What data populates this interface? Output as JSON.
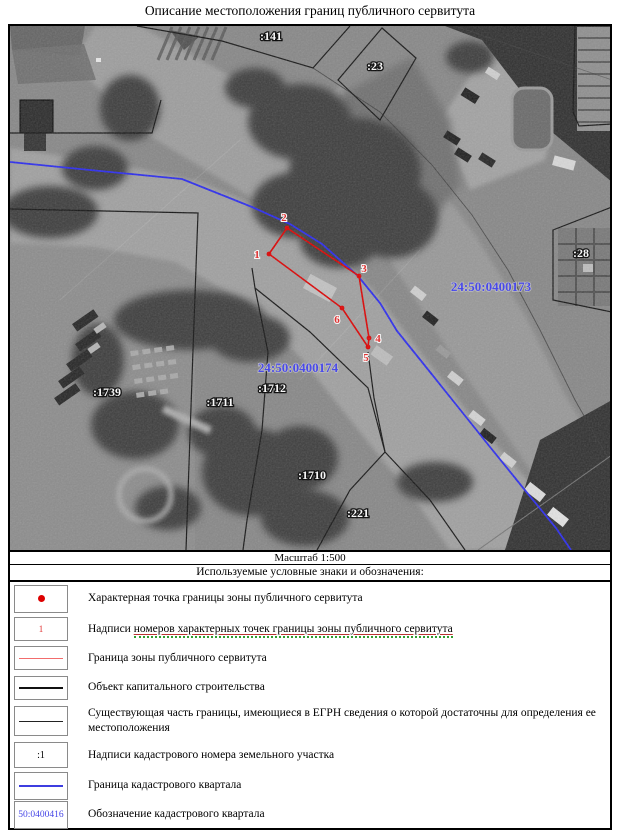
{
  "title": "Описание местоположения границ публичного сервитута",
  "scale_label": "Масштаб 1:500",
  "legend": {
    "header": "Используемые условные знаки и обозначения:",
    "rows": [
      {
        "symbol": "red-dot",
        "text": "Характерная точка границы зоны публичного сервитута"
      },
      {
        "symbol": "red-digit",
        "symbol_text": "1",
        "text_prefix": "Надписи ",
        "text_underlined": "номеров характерных точек границы зоны публичного сервитута"
      },
      {
        "symbol": "red-line",
        "text": "Граница зоны публичного сервитута"
      },
      {
        "symbol": "black-thick-line",
        "text": "Объект капитального строительства"
      },
      {
        "symbol": "black-thin-line",
        "text": "Существующая часть границы, имеющиеся в ЕГРН сведения о которой достаточны для определения ее местоположения"
      },
      {
        "symbol": "cadastral-number",
        "symbol_text": ":1",
        "text": "Надписи кадастрового номера земельного участка"
      },
      {
        "symbol": "blue-line",
        "text": "Граница кадастрового квартала"
      },
      {
        "symbol": "quarter-designation",
        "symbol_text": "50:0400416",
        "text": "Обозначение кадастрового квартала"
      }
    ]
  },
  "map": {
    "parcel_labels": [
      ":141",
      ":23",
      ":28",
      ":1739",
      ":1711",
      ":1712",
      ":1710",
      ":221"
    ],
    "quarter_labels": [
      "24:50:0400173",
      "24:50:0400174"
    ],
    "point_labels": [
      "1",
      "2",
      "3",
      "4",
      "5",
      "6"
    ]
  },
  "colors": {
    "servitude_red": "#dd0000",
    "servitude_legend_red": "#f26c6c",
    "quarter_boundary_blue": "#2a2aee",
    "quarter_label_blue": "#3d3dee",
    "object_black": "#111111"
  }
}
